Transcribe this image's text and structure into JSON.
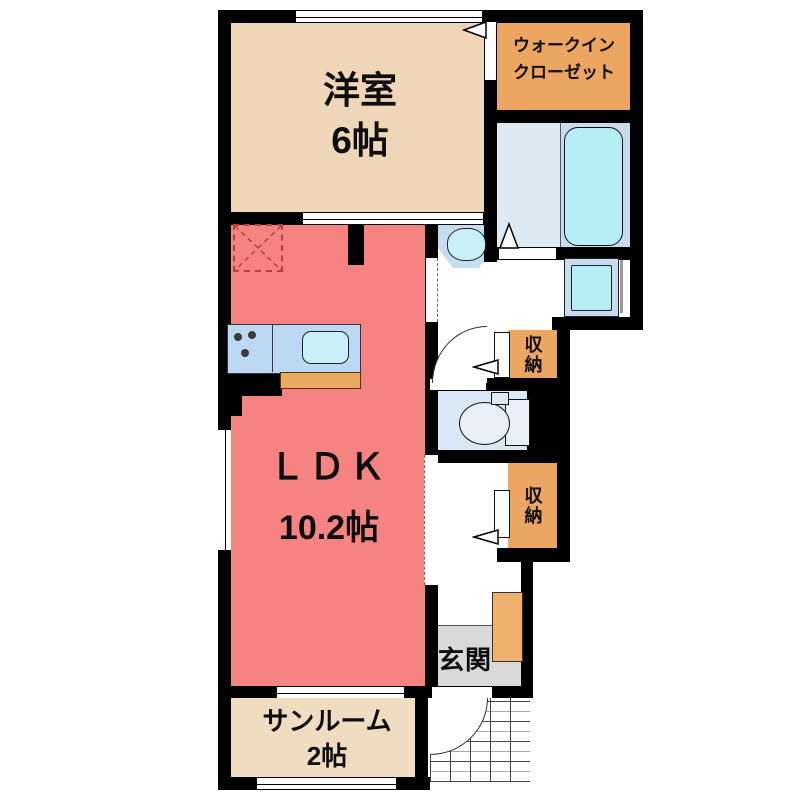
{
  "rooms": {
    "yoshitsu": {
      "line1": "洋室",
      "line2": "6帖"
    },
    "wic": {
      "line1": "ウォークイン",
      "line2": "クローゼット"
    },
    "ldk": {
      "line1": "ＬＤＫ",
      "line2": "10.2帖"
    },
    "sunroom": {
      "line1": "サンルーム",
      "line2": "2帖"
    },
    "storage_upper": {
      "label": "収納"
    },
    "storage_lower": {
      "label": "収納"
    },
    "genkan": {
      "label": "玄関"
    }
  },
  "colors": {
    "wall": "#000000",
    "yoshitsu_floor": "#F0D6B8",
    "wic_floor": "#EDA662",
    "ldk_floor": "#F48382",
    "sunroom_floor": "#F0DCC0",
    "storage_floor": "#EDA662",
    "bath_floor_left": "#DDEAF4",
    "bath_floor_right": "#C9DCEE",
    "bathtub": "#B7EEF6",
    "toilet_floor": "#D9E8F6",
    "kitchen_counter": "#BCD8F2",
    "sink": "#C9F0F8",
    "counter_edge": "#E9AA60",
    "genkan_floor": "#D9D9D9",
    "shoe_cabinet": "#F0B070",
    "fridge_dash": "#B84040"
  }
}
